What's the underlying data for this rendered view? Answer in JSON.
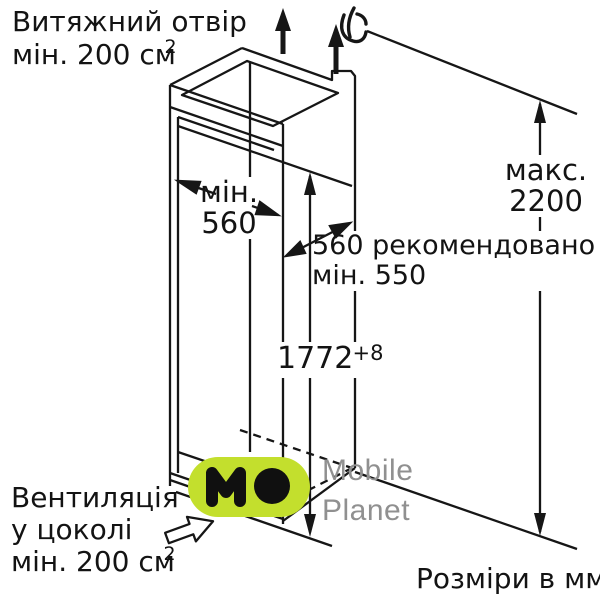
{
  "labels": {
    "exhaust": {
      "line1": "Витяжний отвір",
      "line2": "мін. 200 см",
      "sup": "2"
    },
    "niche_width": {
      "line1": "мін.",
      "line2": "560"
    },
    "depth": {
      "line1": "560 рекомендовано",
      "line2": "мін. 550"
    },
    "max_height": {
      "line1": "макс.",
      "line2": "2200"
    },
    "niche_height": {
      "value": "1772",
      "tolerance": "+8"
    },
    "vent": {
      "line1": "Вентиляція",
      "line2": "у цоколі",
      "line3": "мін. 200 см",
      "sup": "2"
    },
    "units": "Розміри в мм"
  },
  "watermark": {
    "logo_text": "MO",
    "brand_line1": "Mobile",
    "brand_line2": "Planet",
    "logo_color": "#c3df2d",
    "text_color": "#909090"
  },
  "colors": {
    "line": "#161616",
    "background": "#ffffff"
  }
}
